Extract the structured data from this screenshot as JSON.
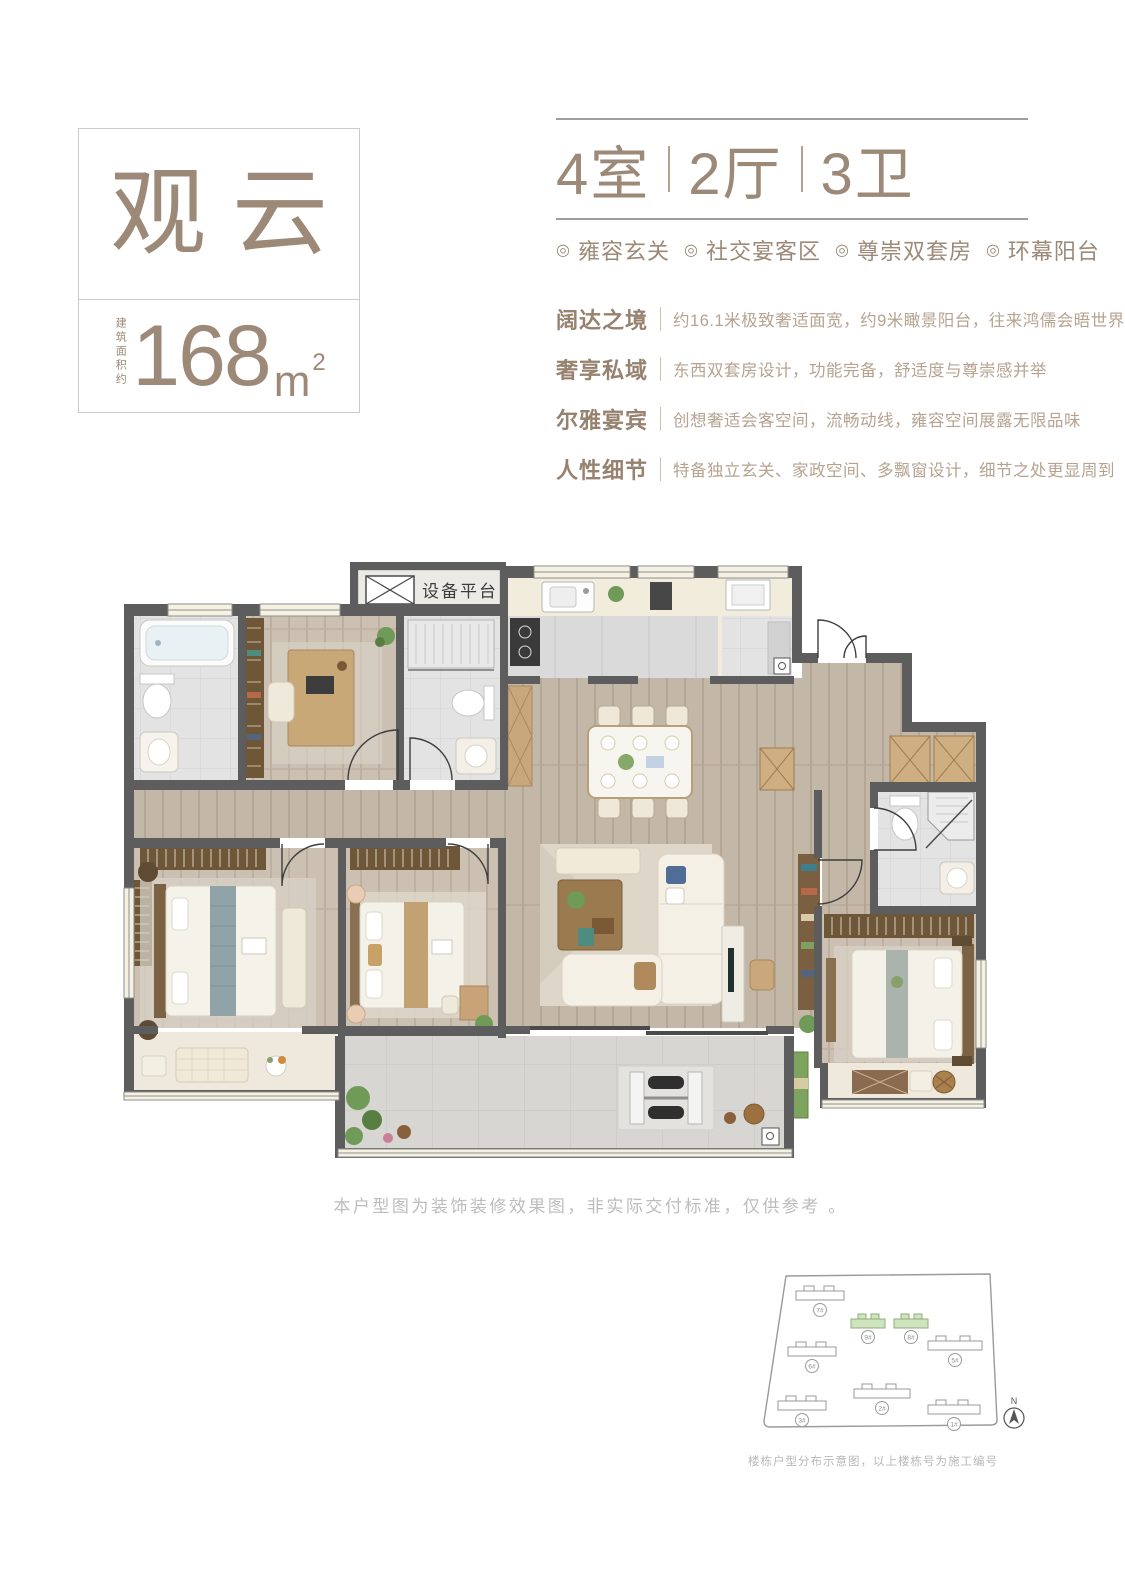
{
  "palette": {
    "brand": "#9c8977",
    "muted_text": "#b6a390",
    "wall": "#5d5d5d",
    "wood": "#c3b7a8",
    "marble": "#e2e2e2",
    "site_highlight": "#cfe3bc"
  },
  "unit": {
    "name": "观云",
    "area_label": "建筑面积约",
    "area_value": "168",
    "area_unit": "m",
    "area_exponent": "2"
  },
  "summary": {
    "rooms": "4室",
    "halls": "2厅",
    "baths": "3卫"
  },
  "features": {
    "marker": "◎",
    "items": [
      "雍容玄关",
      "社交宴客区",
      "尊崇双套房",
      "环幕阳台"
    ]
  },
  "selling_points": [
    {
      "title": "阔达之境",
      "desc": "约16.1米极致奢适面宽，约9米瞰景阳台，往来鸿儒会晤世界"
    },
    {
      "title": "奢享私域",
      "desc": "东西双套房设计，功能完备，舒适度与尊崇感并举"
    },
    {
      "title": "尔雅宴宾",
      "desc": "创想奢适会客空间，流畅动线，雍容空间展露无限品味"
    },
    {
      "title": "人性细节",
      "desc": "特备独立玄关、家政空间、多飘窗设计，细节之处更显周到"
    }
  ],
  "floorplan": {
    "equipment_label": "设备平台"
  },
  "disclaimer": "本户型图为装饰装修效果图，非实际交付标准，仅供参考 。",
  "siteplan": {
    "caption": "楼栋户型分布示意图，以上楼栋号为施工编号",
    "north_label": "N",
    "buildings": [
      {
        "id": "7#",
        "highlighted": false
      },
      {
        "id": "9#",
        "highlighted": true
      },
      {
        "id": "8#",
        "highlighted": true
      },
      {
        "id": "6#",
        "highlighted": false
      },
      {
        "id": "5#",
        "highlighted": false
      },
      {
        "id": "2#",
        "highlighted": false
      },
      {
        "id": "3#",
        "highlighted": false
      },
      {
        "id": "1#",
        "highlighted": false
      }
    ]
  }
}
